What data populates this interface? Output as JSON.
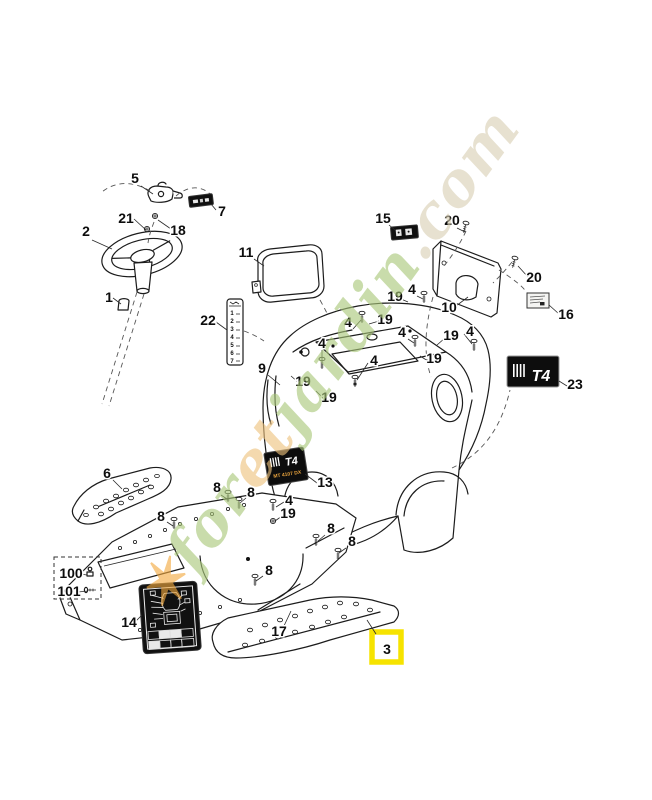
{
  "watermark": {
    "parts": [
      {
        "text": "✶",
        "color": "#f3a93e"
      },
      {
        "text": "for",
        "color": "#a9c878"
      },
      {
        "text": "et",
        "color": "#eec27d"
      },
      {
        "text": "jardin",
        "color": "#a9c878"
      },
      {
        "text": ".com",
        "color": "#d9cfb4"
      }
    ]
  },
  "gear_strip": {
    "rows": [
      "1",
      "2",
      "3",
      "4",
      "5",
      "6",
      "7"
    ]
  },
  "body_label": {
    "logo": "T4",
    "model": "MT 4107 DX"
  },
  "rear_label": {
    "logo": "T4"
  },
  "highlight": {
    "number": "3",
    "color": "#f6e300"
  },
  "callouts": [
    {
      "n": "5",
      "x": 135,
      "y": 183
    },
    {
      "n": "7",
      "x": 222,
      "y": 216
    },
    {
      "n": "21",
      "x": 126,
      "y": 223
    },
    {
      "n": "18",
      "x": 178,
      "y": 235
    },
    {
      "n": "2",
      "x": 86,
      "y": 236
    },
    {
      "n": "1",
      "x": 109,
      "y": 302
    },
    {
      "n": "11",
      "x": 246,
      "y": 257
    },
    {
      "n": "22",
      "x": 208,
      "y": 325
    },
    {
      "n": "15",
      "x": 383,
      "y": 223
    },
    {
      "n": "20",
      "x": 452,
      "y": 225
    },
    {
      "n": "20",
      "x": 534,
      "y": 282
    },
    {
      "n": "10",
      "x": 449,
      "y": 312
    },
    {
      "n": "16",
      "x": 566,
      "y": 319
    },
    {
      "n": "23",
      "x": 575,
      "y": 389
    },
    {
      "n": "9",
      "x": 262,
      "y": 373
    },
    {
      "n": "4",
      "x": 348,
      "y": 327
    },
    {
      "n": "19",
      "x": 385,
      "y": 324
    },
    {
      "n": "4",
      "x": 412,
      "y": 294
    },
    {
      "n": "19",
      "x": 395,
      "y": 301
    },
    {
      "n": "4",
      "x": 470,
      "y": 336
    },
    {
      "n": "19",
      "x": 451,
      "y": 340
    },
    {
      "n": "4",
      "x": 402,
      "y": 337
    },
    {
      "n": "19",
      "x": 434,
      "y": 363
    },
    {
      "n": "4",
      "x": 322,
      "y": 348
    },
    {
      "n": "19",
      "x": 303,
      "y": 386
    },
    {
      "n": "4",
      "x": 374,
      "y": 365
    },
    {
      "n": "19",
      "x": 329,
      "y": 402
    },
    {
      "n": "13",
      "x": 325,
      "y": 487
    },
    {
      "n": "6",
      "x": 107,
      "y": 478
    },
    {
      "n": "8",
      "x": 217,
      "y": 492
    },
    {
      "n": "8",
      "x": 251,
      "y": 497
    },
    {
      "n": "8",
      "x": 161,
      "y": 521
    },
    {
      "n": "8",
      "x": 331,
      "y": 533
    },
    {
      "n": "8",
      "x": 352,
      "y": 546
    },
    {
      "n": "8",
      "x": 269,
      "y": 575
    },
    {
      "n": "4",
      "x": 289,
      "y": 505
    },
    {
      "n": "19",
      "x": 288,
      "y": 518
    },
    {
      "n": "17",
      "x": 279,
      "y": 636
    },
    {
      "n": "14",
      "x": 129,
      "y": 627
    },
    {
      "n": "100",
      "x": 71,
      "y": 578
    },
    {
      "n": "101",
      "x": 69,
      "y": 596
    },
    {
      "n": "3",
      "x": 387,
      "y": 654
    }
  ]
}
